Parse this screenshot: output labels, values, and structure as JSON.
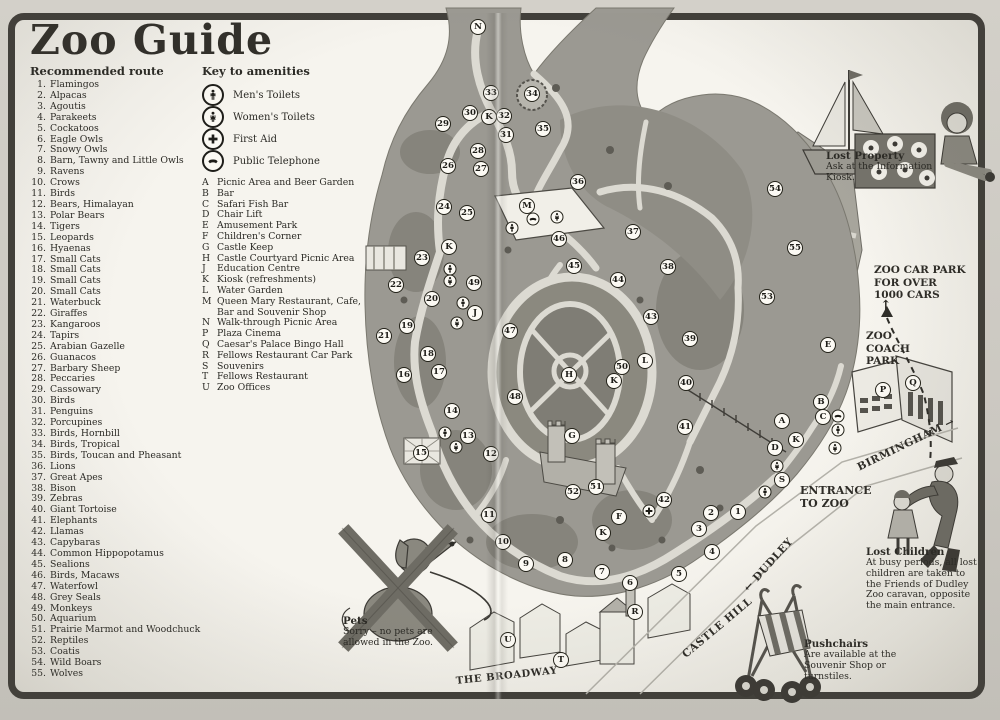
{
  "page": {
    "title": "Zoo Guide"
  },
  "colors": {
    "paper": "#f4f2ec",
    "frame": "#413f3a",
    "ground": "#9b9992",
    "path": "#dcdad2",
    "ink": "#2b2a25"
  },
  "route": {
    "heading": "Recommended route",
    "items": [
      "Flamingos",
      "Alpacas",
      "Agoutis",
      "Parakeets",
      "Cockatoos",
      "Eagle Owls",
      "Snowy Owls",
      "Barn, Tawny and Little Owls",
      "Ravens",
      "Crows",
      "Birds",
      "Bears, Himalayan",
      "Polar Bears",
      "Tigers",
      "Leopards",
      "Hyaenas",
      "Small Cats",
      "Small Cats",
      "Small Cats",
      "Small Cats",
      "Waterbuck",
      "Giraffes",
      "Kangaroos",
      "Tapirs",
      "Arabian Gazelle",
      "Guanacos",
      "Barbary Sheep",
      "Peccaries",
      "Cassowary",
      "Birds",
      "Penguins",
      "Porcupines",
      "Birds, Hornbill",
      "Birds, Tropical",
      "Birds, Toucan and Pheasant",
      "Lions",
      "Great Apes",
      "Bison",
      "Zebras",
      "Giant Tortoise",
      "Elephants",
      "Llamas",
      "Capybaras",
      "Common Hippopotamus",
      "Sealions",
      "Birds, Macaws",
      "Waterfowl",
      "Grey Seals",
      "Monkeys",
      "Aquarium",
      "Prairie Marmot and Woodchuck",
      "Reptiles",
      "Coatis",
      "Wild Boars",
      "Wolves"
    ]
  },
  "amenities": {
    "heading": "Key to amenities",
    "icons": [
      {
        "type": "mens-toilet",
        "label": "Men's Toilets"
      },
      {
        "type": "womens-toilet",
        "label": "Women's Toilets"
      },
      {
        "type": "first-aid",
        "label": "First Aid"
      },
      {
        "type": "telephone",
        "label": "Public Telephone"
      }
    ],
    "key": [
      {
        "letter": "A",
        "label": "Picnic Area and Beer Garden"
      },
      {
        "letter": "B",
        "label": "Bar"
      },
      {
        "letter": "C",
        "label": "Safari Fish Bar"
      },
      {
        "letter": "D",
        "label": "Chair Lift"
      },
      {
        "letter": "E",
        "label": "Amusement Park"
      },
      {
        "letter": "F",
        "label": "Children's Corner"
      },
      {
        "letter": "G",
        "label": "Castle Keep"
      },
      {
        "letter": "H",
        "label": "Castle Courtyard Picnic Area"
      },
      {
        "letter": "J",
        "label": "Education Centre"
      },
      {
        "letter": "K",
        "label": "Kiosk (refreshments)"
      },
      {
        "letter": "L",
        "label": "Water Garden"
      },
      {
        "letter": "M",
        "label": "Queen Mary Restaurant, Cafe, Bar and Souvenir Shop"
      },
      {
        "letter": "N",
        "label": "Walk-through Picnic Area"
      },
      {
        "letter": "P",
        "label": "Plaza Cinema"
      },
      {
        "letter": "Q",
        "label": "Caesar's Palace Bingo Hall"
      },
      {
        "letter": "R",
        "label": "Fellows Restaurant Car Park"
      },
      {
        "letter": "S",
        "label": "Souvenirs"
      },
      {
        "letter": "T",
        "label": "Fellows Restaurant"
      },
      {
        "letter": "U",
        "label": "Zoo Offices"
      }
    ]
  },
  "map": {
    "labels": {
      "car_park": [
        "ZOO CAR PARK",
        "FOR OVER",
        "1000 CARS"
      ],
      "car_park_arrow": "↑",
      "coach_park": [
        "ZOO",
        "COACH",
        "PARK"
      ],
      "entrance": [
        "ENTRANCE",
        "TO ZOO"
      ],
      "birmingham": "BIRMINGHAM →",
      "dudley": "← DUDLEY",
      "castle_hill": "CASTLE HILL",
      "broadway": "THE BROADWAY"
    },
    "annotations": {
      "lost_property": {
        "title": "Lost Property",
        "body": "Ask at the Information Kiosk."
      },
      "lost_children": {
        "title": "Lost Children",
        "body": "At busy periods, all lost children are taken to the Friends of Dudley Zoo caravan, opposite the main entrance."
      },
      "pushchairs": {
        "title": "Pushchairs",
        "body": "Are available at the Souvenir Shop or turnstiles."
      },
      "pets": {
        "title": "Pets",
        "body": "Sorry – no pets are allowed in the Zoo."
      }
    },
    "markers": [
      {
        "kind": "number",
        "label": "1",
        "x": 738,
        "y": 512
      },
      {
        "kind": "number",
        "label": "2",
        "x": 711,
        "y": 513
      },
      {
        "kind": "number",
        "label": "3",
        "x": 699,
        "y": 529
      },
      {
        "kind": "number",
        "label": "4",
        "x": 712,
        "y": 552
      },
      {
        "kind": "number",
        "label": "5",
        "x": 679,
        "y": 574
      },
      {
        "kind": "number",
        "label": "6",
        "x": 630,
        "y": 583
      },
      {
        "kind": "number",
        "label": "7",
        "x": 602,
        "y": 572
      },
      {
        "kind": "number",
        "label": "8",
        "x": 565,
        "y": 560
      },
      {
        "kind": "number",
        "label": "9",
        "x": 526,
        "y": 564
      },
      {
        "kind": "number",
        "label": "10",
        "x": 503,
        "y": 542
      },
      {
        "kind": "number",
        "label": "11",
        "x": 489,
        "y": 515
      },
      {
        "kind": "number",
        "label": "12",
        "x": 491,
        "y": 454
      },
      {
        "kind": "number",
        "label": "13",
        "x": 468,
        "y": 436
      },
      {
        "kind": "number",
        "label": "14",
        "x": 452,
        "y": 411
      },
      {
        "kind": "number",
        "label": "15",
        "x": 421,
        "y": 453
      },
      {
        "kind": "number",
        "label": "16",
        "x": 404,
        "y": 375
      },
      {
        "kind": "number",
        "label": "17",
        "x": 439,
        "y": 372
      },
      {
        "kind": "number",
        "label": "18",
        "x": 428,
        "y": 354
      },
      {
        "kind": "number",
        "label": "19",
        "x": 407,
        "y": 326
      },
      {
        "kind": "number",
        "label": "20",
        "x": 432,
        "y": 299
      },
      {
        "kind": "number",
        "label": "21",
        "x": 384,
        "y": 336
      },
      {
        "kind": "number",
        "label": "22",
        "x": 396,
        "y": 285
      },
      {
        "kind": "number",
        "label": "23",
        "x": 422,
        "y": 258
      },
      {
        "kind": "number",
        "label": "24",
        "x": 444,
        "y": 207
      },
      {
        "kind": "number",
        "label": "25",
        "x": 467,
        "y": 213
      },
      {
        "kind": "number",
        "label": "26",
        "x": 448,
        "y": 166
      },
      {
        "kind": "number",
        "label": "27",
        "x": 481,
        "y": 169
      },
      {
        "kind": "number",
        "label": "28",
        "x": 478,
        "y": 151
      },
      {
        "kind": "number",
        "label": "29",
        "x": 443,
        "y": 124
      },
      {
        "kind": "number",
        "label": "30",
        "x": 470,
        "y": 113
      },
      {
        "kind": "number",
        "label": "31",
        "x": 506,
        "y": 135
      },
      {
        "kind": "number",
        "label": "32",
        "x": 504,
        "y": 116
      },
      {
        "kind": "number",
        "label": "33",
        "x": 491,
        "y": 93
      },
      {
        "kind": "number",
        "label": "34",
        "x": 532,
        "y": 94
      },
      {
        "kind": "number",
        "label": "35",
        "x": 543,
        "y": 129
      },
      {
        "kind": "number",
        "label": "36",
        "x": 578,
        "y": 182
      },
      {
        "kind": "number",
        "label": "37",
        "x": 633,
        "y": 232
      },
      {
        "kind": "number",
        "label": "38",
        "x": 668,
        "y": 267
      },
      {
        "kind": "number",
        "label": "39",
        "x": 690,
        "y": 339
      },
      {
        "kind": "number",
        "label": "40",
        "x": 686,
        "y": 383
      },
      {
        "kind": "number",
        "label": "41",
        "x": 685,
        "y": 427
      },
      {
        "kind": "number",
        "label": "42",
        "x": 664,
        "y": 500
      },
      {
        "kind": "number",
        "label": "43",
        "x": 651,
        "y": 317
      },
      {
        "kind": "number",
        "label": "44",
        "x": 618,
        "y": 280
      },
      {
        "kind": "number",
        "label": "45",
        "x": 574,
        "y": 266
      },
      {
        "kind": "number",
        "label": "46",
        "x": 559,
        "y": 239
      },
      {
        "kind": "number",
        "label": "47",
        "x": 510,
        "y": 331
      },
      {
        "kind": "number",
        "label": "48",
        "x": 515,
        "y": 397
      },
      {
        "kind": "number",
        "label": "49",
        "x": 474,
        "y": 283
      },
      {
        "kind": "number",
        "label": "50",
        "x": 622,
        "y": 367
      },
      {
        "kind": "number",
        "label": "51",
        "x": 596,
        "y": 487
      },
      {
        "kind": "number",
        "label": "52",
        "x": 573,
        "y": 492
      },
      {
        "kind": "number",
        "label": "53",
        "x": 767,
        "y": 297
      },
      {
        "kind": "number",
        "label": "54",
        "x": 775,
        "y": 189
      },
      {
        "kind": "number",
        "label": "55",
        "x": 795,
        "y": 248
      },
      {
        "kind": "letter",
        "label": "A",
        "x": 782,
        "y": 421
      },
      {
        "kind": "letter",
        "label": "B",
        "x": 821,
        "y": 402
      },
      {
        "kind": "letter",
        "label": "C",
        "x": 823,
        "y": 417
      },
      {
        "kind": "letter",
        "label": "D",
        "x": 775,
        "y": 448
      },
      {
        "kind": "letter",
        "label": "E",
        "x": 828,
        "y": 345
      },
      {
        "kind": "letter",
        "label": "F",
        "x": 619,
        "y": 517
      },
      {
        "kind": "letter",
        "label": "G",
        "x": 572,
        "y": 436
      },
      {
        "kind": "letter",
        "label": "H",
        "x": 569,
        "y": 375
      },
      {
        "kind": "letter",
        "label": "J",
        "x": 475,
        "y": 313
      },
      {
        "kind": "letter",
        "label": "K",
        "x": 489,
        "y": 117
      },
      {
        "kind": "letter",
        "label": "K",
        "x": 449,
        "y": 247
      },
      {
        "kind": "letter",
        "label": "K",
        "x": 614,
        "y": 381
      },
      {
        "kind": "letter",
        "label": "K",
        "x": 603,
        "y": 533
      },
      {
        "kind": "letter",
        "label": "K",
        "x": 796,
        "y": 440
      },
      {
        "kind": "letter",
        "label": "L",
        "x": 645,
        "y": 361
      },
      {
        "kind": "letter",
        "label": "M",
        "x": 527,
        "y": 206
      },
      {
        "kind": "letter",
        "label": "N",
        "x": 478,
        "y": 27
      },
      {
        "kind": "letter",
        "label": "P",
        "x": 883,
        "y": 390
      },
      {
        "kind": "letter",
        "label": "Q",
        "x": 913,
        "y": 383
      },
      {
        "kind": "letter",
        "label": "R",
        "x": 635,
        "y": 612
      },
      {
        "kind": "letter",
        "label": "S",
        "x": 782,
        "y": 480
      },
      {
        "kind": "letter",
        "label": "T",
        "x": 561,
        "y": 660
      },
      {
        "kind": "letter",
        "label": "U",
        "x": 508,
        "y": 640
      },
      {
        "kind": "icon",
        "icon": "mens-toilet",
        "x": 512,
        "y": 228
      },
      {
        "kind": "icon",
        "icon": "telephone",
        "x": 533,
        "y": 219
      },
      {
        "kind": "icon",
        "icon": "womens-toilet",
        "x": 557,
        "y": 217
      },
      {
        "kind": "icon",
        "icon": "mens-toilet",
        "x": 450,
        "y": 269
      },
      {
        "kind": "icon",
        "icon": "womens-toilet",
        "x": 450,
        "y": 281
      },
      {
        "kind": "icon",
        "icon": "mens-toilet",
        "x": 463,
        "y": 303
      },
      {
        "kind": "icon",
        "icon": "womens-toilet",
        "x": 457,
        "y": 323
      },
      {
        "kind": "icon",
        "icon": "mens-toilet",
        "x": 445,
        "y": 433
      },
      {
        "kind": "icon",
        "icon": "womens-toilet",
        "x": 456,
        "y": 447
      },
      {
        "kind": "icon",
        "icon": "first-aid",
        "x": 649,
        "y": 511
      },
      {
        "kind": "icon",
        "icon": "mens-toilet",
        "x": 765,
        "y": 492
      },
      {
        "kind": "icon",
        "icon": "womens-toilet",
        "x": 777,
        "y": 466
      },
      {
        "kind": "icon",
        "icon": "womens-toilet",
        "x": 835,
        "y": 448
      },
      {
        "kind": "icon",
        "icon": "mens-toilet",
        "x": 838,
        "y": 430
      },
      {
        "kind": "icon",
        "icon": "telephone",
        "x": 838,
        "y": 416
      }
    ]
  }
}
